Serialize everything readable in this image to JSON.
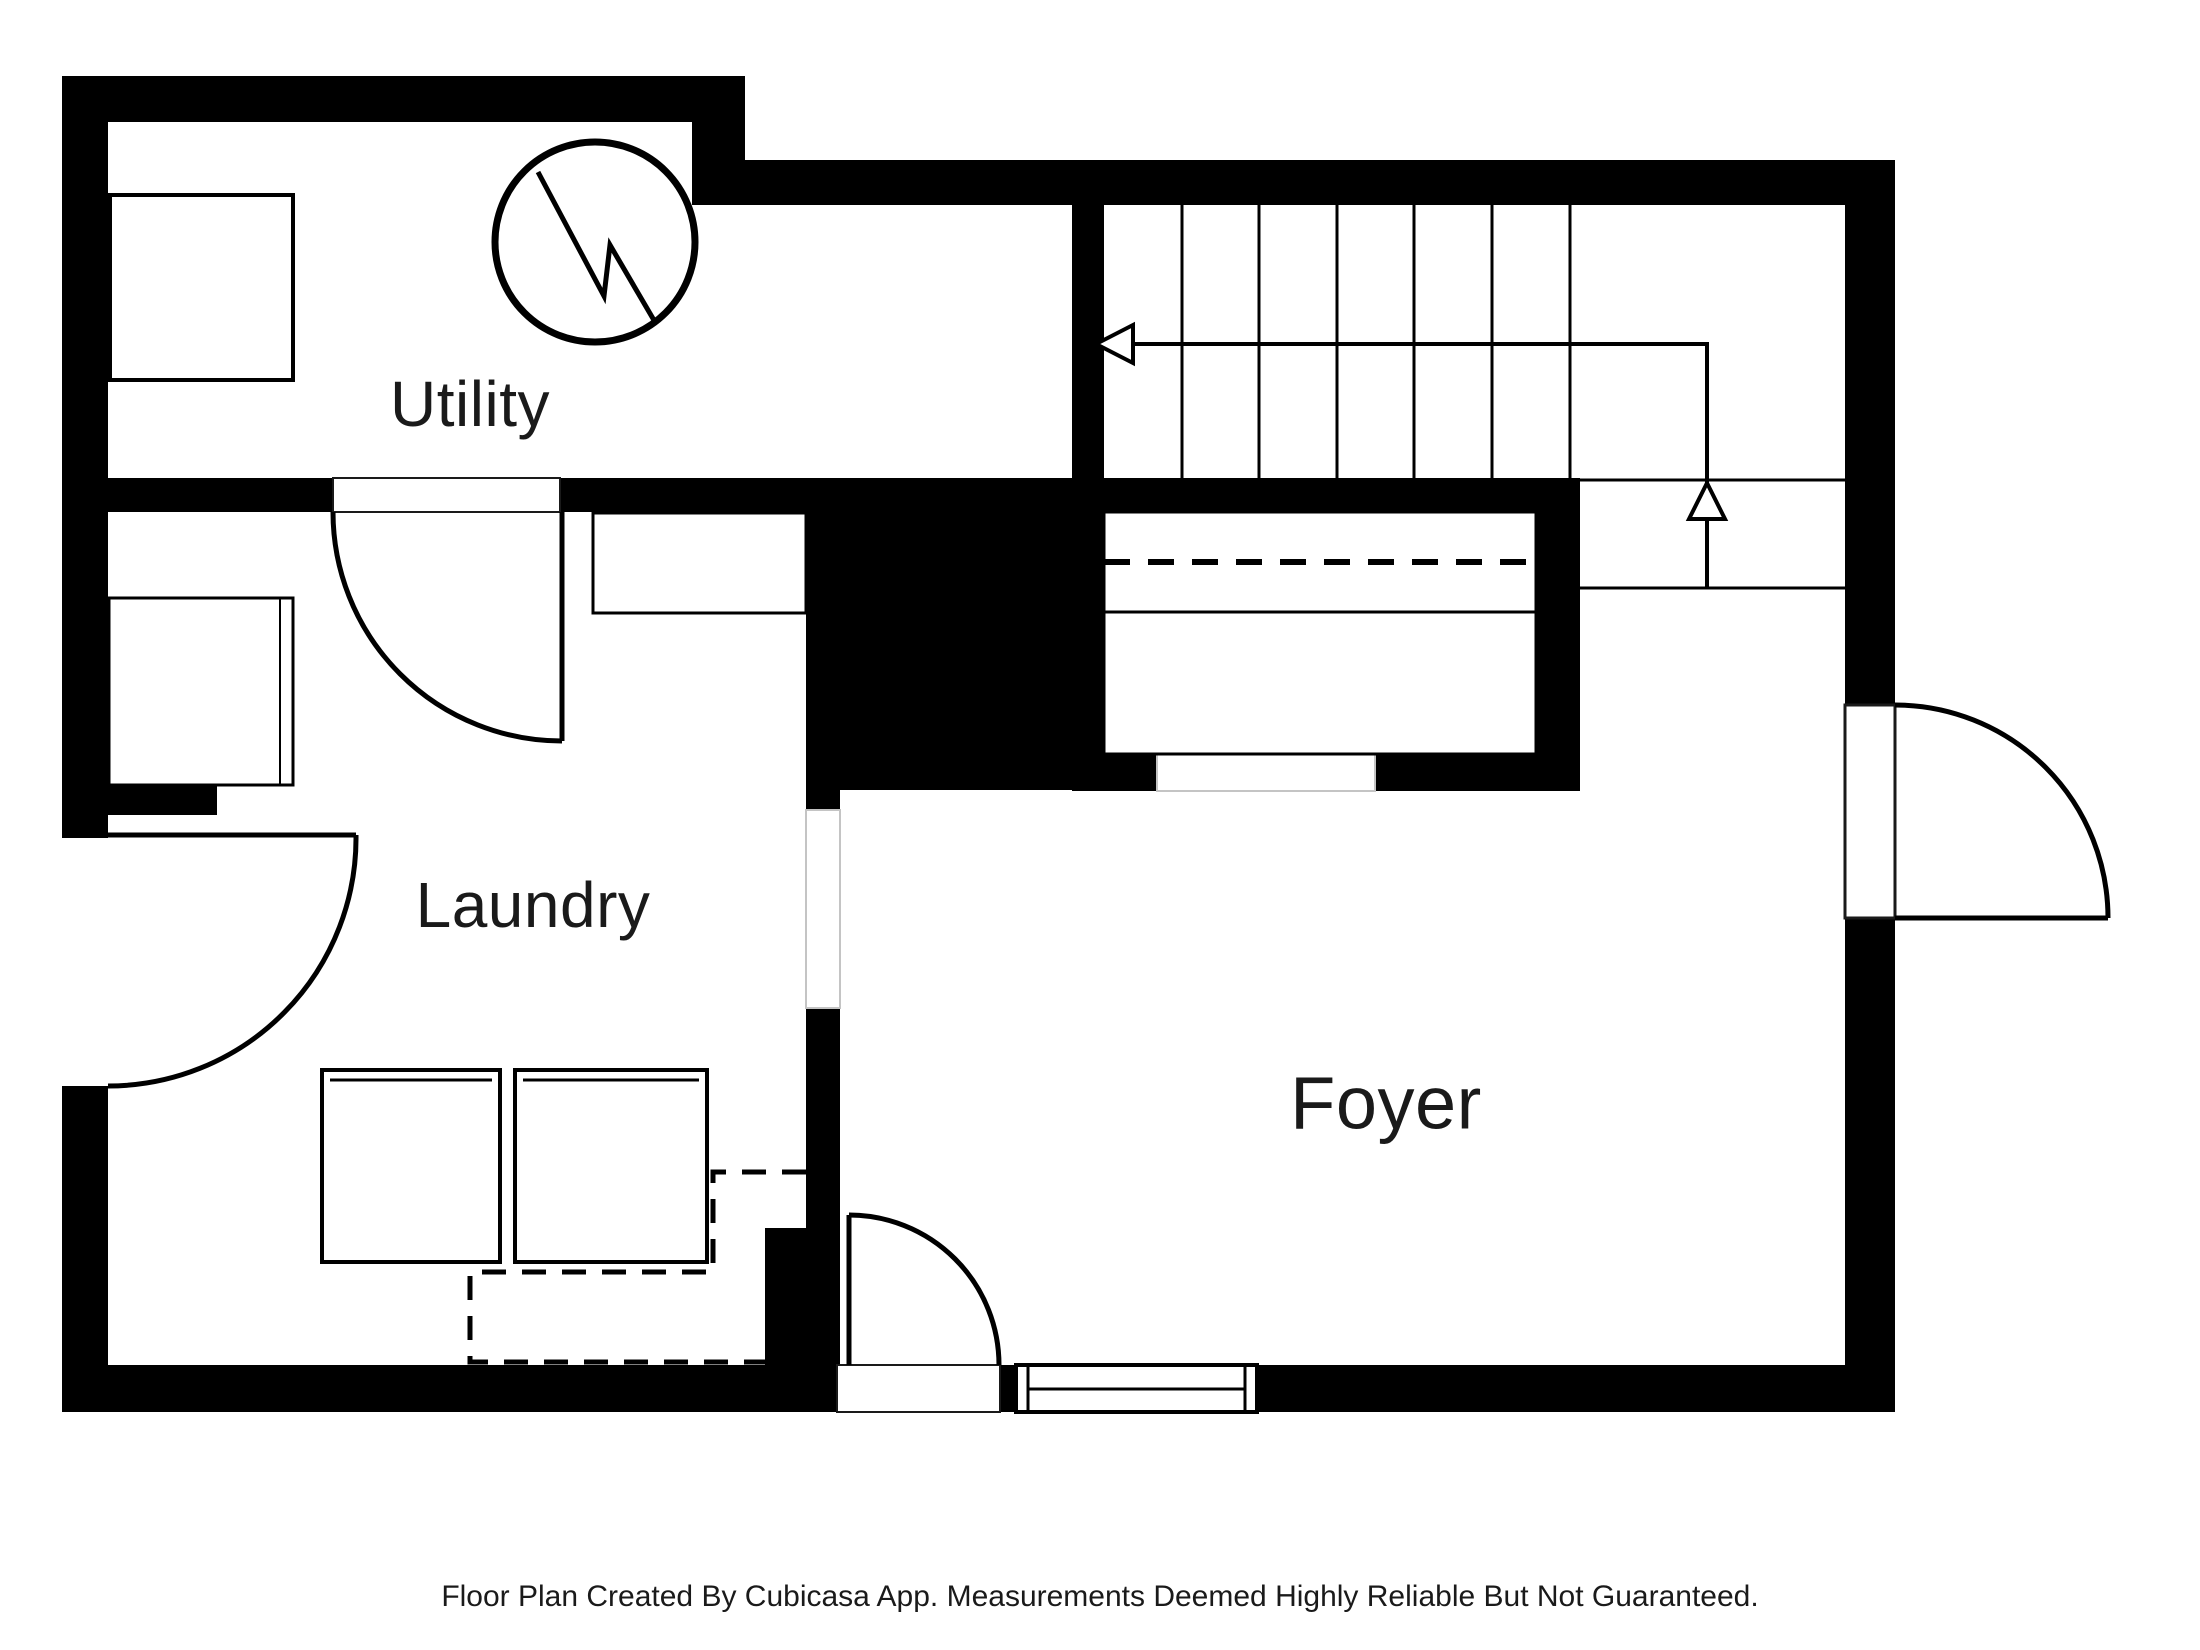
{
  "document": {
    "type": "floor-plan",
    "creator_note": "Floor Plan Created By Cubicasa App. Measurements Deemed Highly Reliable But Not Guaranteed."
  },
  "rooms": {
    "utility": "Utility",
    "laundry": "Laundry",
    "foyer": "Foyer"
  },
  "colors": {
    "background": "#ffffff",
    "wall": "#000000",
    "line": "#000000",
    "text": "#1a1a1a",
    "opening_outline": "#c4c4c4"
  },
  "icons": {
    "electrical_panel": "circle-with-lightning-bolt",
    "stairs_up_arrow": "l-shaped-arrow-with-open-heads",
    "door_swings": "quarter-circle-arcs",
    "window": "double-lined-rect-in-wall",
    "appliances": "washer-and-dryer-squares"
  }
}
